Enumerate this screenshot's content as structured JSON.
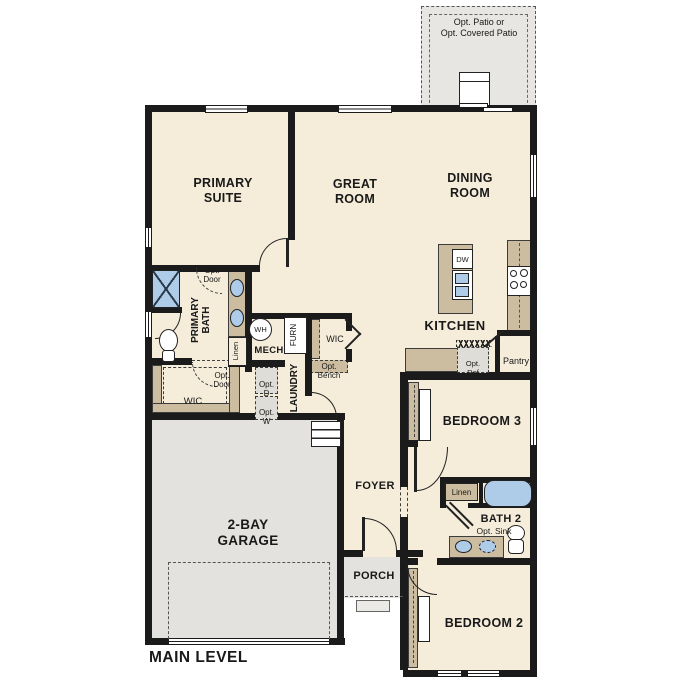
{
  "colors": {
    "floor": "#f5edda",
    "garage": "#e3e2de",
    "patio": "#e7e6e2",
    "counter": "#ccbda0",
    "blue": "#aecbe8",
    "wall": "#1b1b1b",
    "optfill": "#deddd8"
  },
  "title": {
    "main_level": "MAIN LEVEL"
  },
  "patio": {
    "label": "Opt. Patio or\nOpt. Covered Patio"
  },
  "rooms": {
    "primary_suite": "PRIMARY\nSUITE",
    "great_room": "GREAT\nROOM",
    "dining_room": "DINING\nROOM",
    "kitchen": "KITCHEN",
    "primary_bath": "PRIMARY\nBATH",
    "mech": "MECH",
    "laundry": "LAUNDRY",
    "wic_upper": "WIC",
    "wic_lower": "WIC",
    "foyer": "FOYER",
    "porch": "PORCH",
    "garage": "2-BAY\nGARAGE",
    "bedroom2": "BEDROOM 2",
    "bedroom3": "BEDROOM 3",
    "bath2": "BATH 2",
    "pantry": "Pantry"
  },
  "fixtures": {
    "water_heater": "WH",
    "furnace": "FURN",
    "dishwasher": "DW",
    "linen_primary": "Linen",
    "linen_bath2": "Linen"
  },
  "options": {
    "opt_door_bath": "Opt.\nDoor",
    "opt_door_wic": "Opt.\nDoor",
    "opt_bench": "Opt.\nBench",
    "opt_dryer": "Opt.\nD",
    "opt_washer": "Opt.\nW",
    "opt_ref": "Opt.\nRef",
    "opt_sink": "Opt. Sink"
  }
}
